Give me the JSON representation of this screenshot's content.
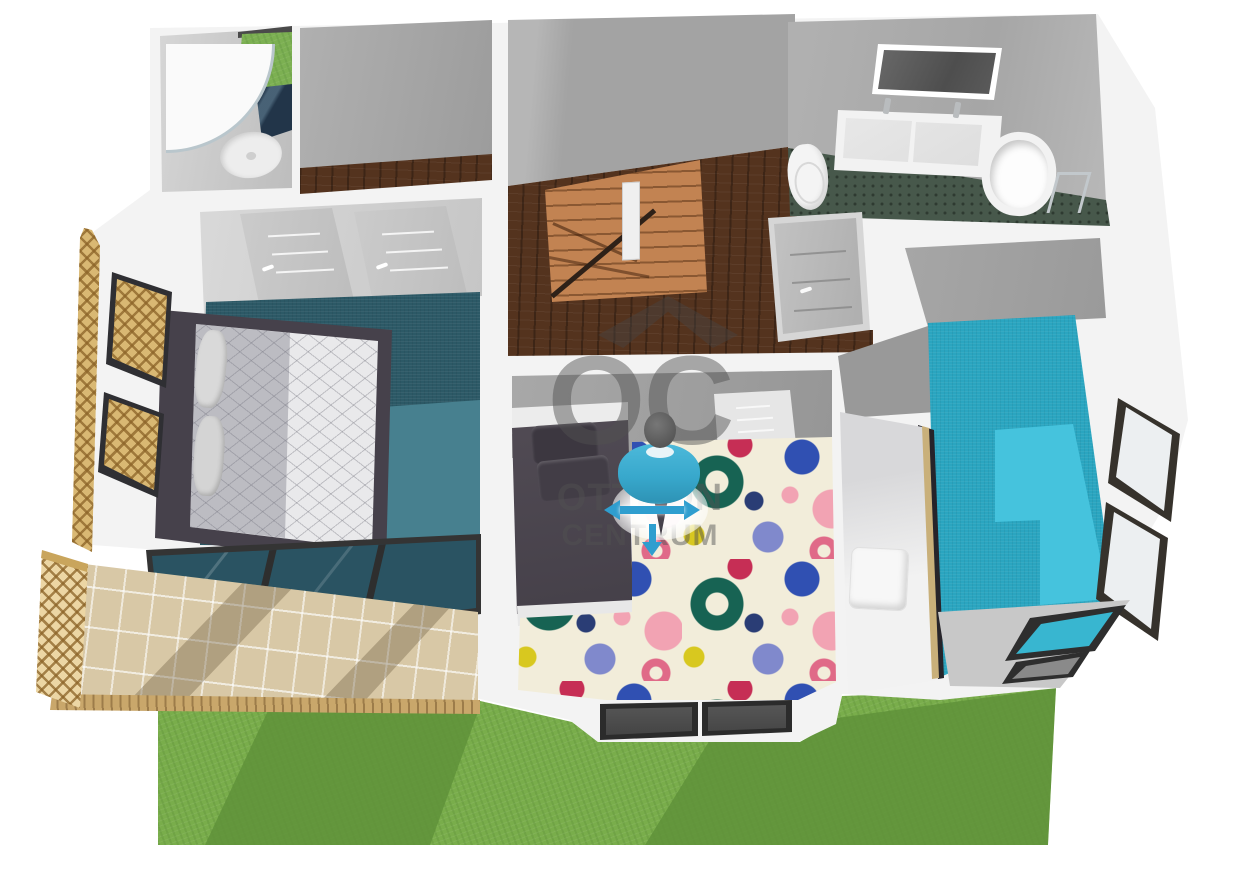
{
  "watermark": {
    "roof_icon": "house-roof",
    "logo": "OC",
    "line1": "OTTHON",
    "line2": "CENTRUM"
  },
  "avatar": {
    "type": "person-marker",
    "arrow_icons": [
      "move-left-arrow",
      "move-right-arrow",
      "move-down-arrow"
    ]
  },
  "colors": {
    "background": "#ffffff",
    "wall_white": "#f3f3f3",
    "wall_grey": "#a6a6a6",
    "wall_grey_light": "#c9c9c9",
    "wood_dark": "#54331e",
    "wood_stair": "#c28352",
    "carpet_master": "#2c5966",
    "carpet_master_lit": "#47808f",
    "carpet_child_base": "#f2edda",
    "carpet_right": "#2aa5c0",
    "carpet_right_lit": "#45c3dd",
    "bathroom_floor": "#47584b",
    "navy_tile": "#223549",
    "terrace_tile": "#d8c8a6",
    "lattice_wood": "#d9b873",
    "grass_light": "#79ad4b",
    "grass_dark": "#5f923a",
    "bed_dark": "#46414b",
    "mattress": "#e9e9eb",
    "avatar_shirt": "#38a8cc",
    "arrow_blue": "#2f9ecf",
    "watermark_grey": "#6e6e6e",
    "rug_teal": "#176353",
    "rug_blue": "#3050b2",
    "rug_periwinkle": "#8089cc",
    "rug_pink": "#f2a3b3",
    "rug_crimson": "#c62e55",
    "rug_yellow": "#d8c81f",
    "rug_rose": "#e06a88",
    "rug_navy": "#2a3d75"
  }
}
